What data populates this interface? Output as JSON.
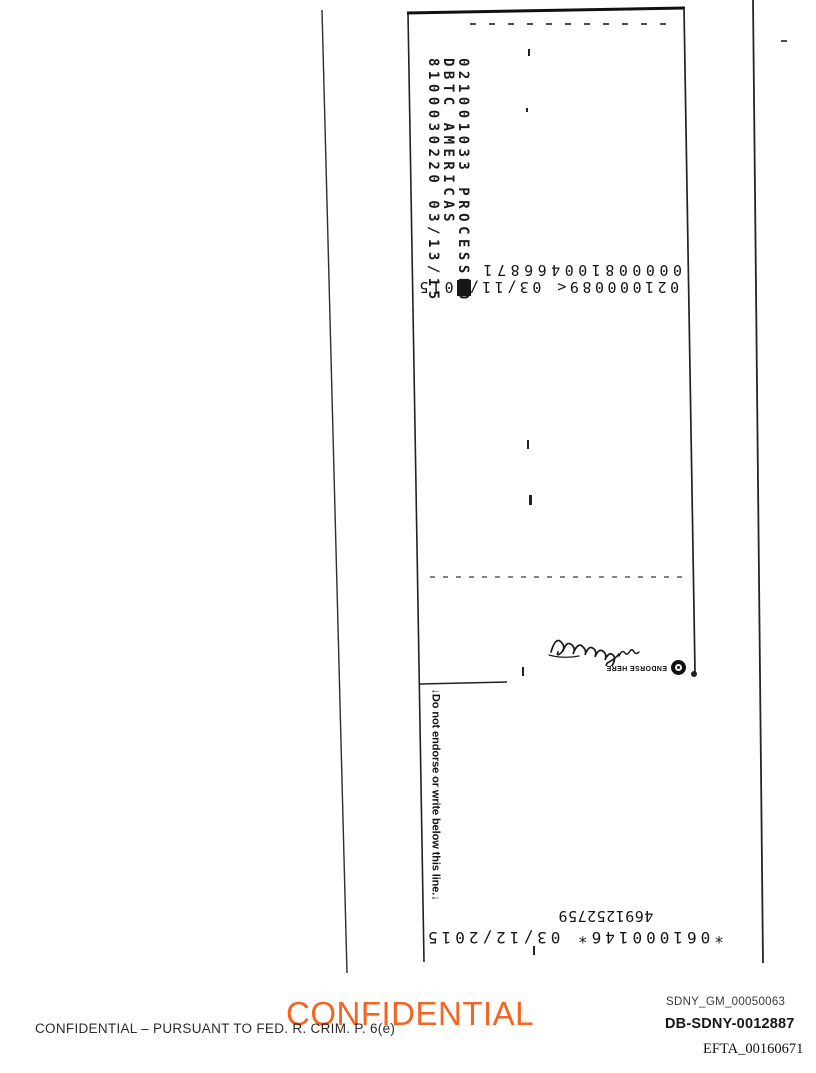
{
  "scan": {
    "bank_stamp": {
      "line1": "021001033 PROCESSED",
      "line2": "DBTC AMERICAS",
      "line3": "8100030220 03/13/15"
    },
    "micr_top": {
      "line1": "000008100466871",
      "line2": "021000089<  03/11/2015"
    },
    "endorse_stamp": {
      "label": "ENDORSE HERE",
      "logo_icon": "ring-dot-icon"
    },
    "endorse_boundary": {
      "label": "↓Do not endorse or write below this line.↓"
    },
    "micr_bottom": {
      "line1": "4691252759",
      "line2": "*061000146*  03/12/2015"
    }
  },
  "footer": {
    "confidential_stamp": "CONFIDENTIAL",
    "confidential_stamp_color": "#f26522",
    "legal_line": "CONFIDENTIAL – PURSUANT TO FED. R. CRIM. P. 6(e)",
    "bates_number_top": "SDNY_GM_00050063",
    "bates_number_middle": "DB-SDNY-0012887",
    "bates_number_bottom": "EFTA_00160671"
  }
}
